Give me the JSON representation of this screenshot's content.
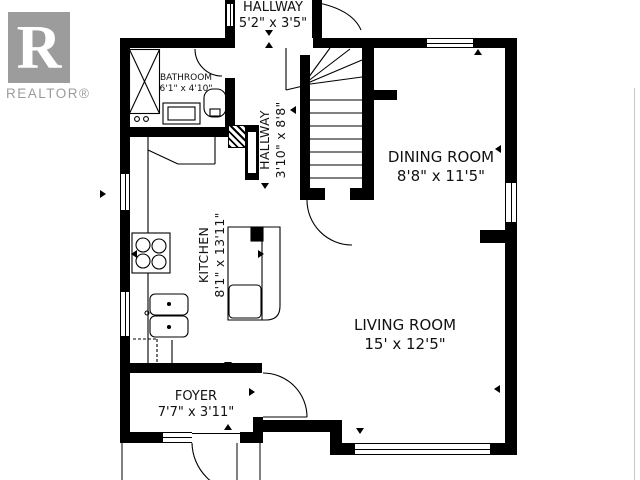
{
  "logo": {
    "letter": "R",
    "label": "REALTOR®"
  },
  "rooms": {
    "hallway_top": {
      "name": "HALLWAY",
      "dims": "5'2\" x 3'5\""
    },
    "bathroom": {
      "name": "BATHROOM",
      "dims": "6'1\" x 4'10\""
    },
    "hallway_main": {
      "name": "HALLWAY",
      "dims": "3'10\" x 8'8\""
    },
    "dining_room": {
      "name": "DINING ROOM",
      "dims": "8'8\" x 11'5\""
    },
    "kitchen": {
      "name": "KITCHEN",
      "dims": "8'1\" x 13'11\""
    },
    "living_room": {
      "name": "LIVING ROOM",
      "dims": "15' x 12'5\""
    },
    "foyer": {
      "name": "FOYER",
      "dims": "7'7\" x 3'11\""
    }
  },
  "colors": {
    "wall": "#000000",
    "logo_gray": "#9c9c9c"
  }
}
